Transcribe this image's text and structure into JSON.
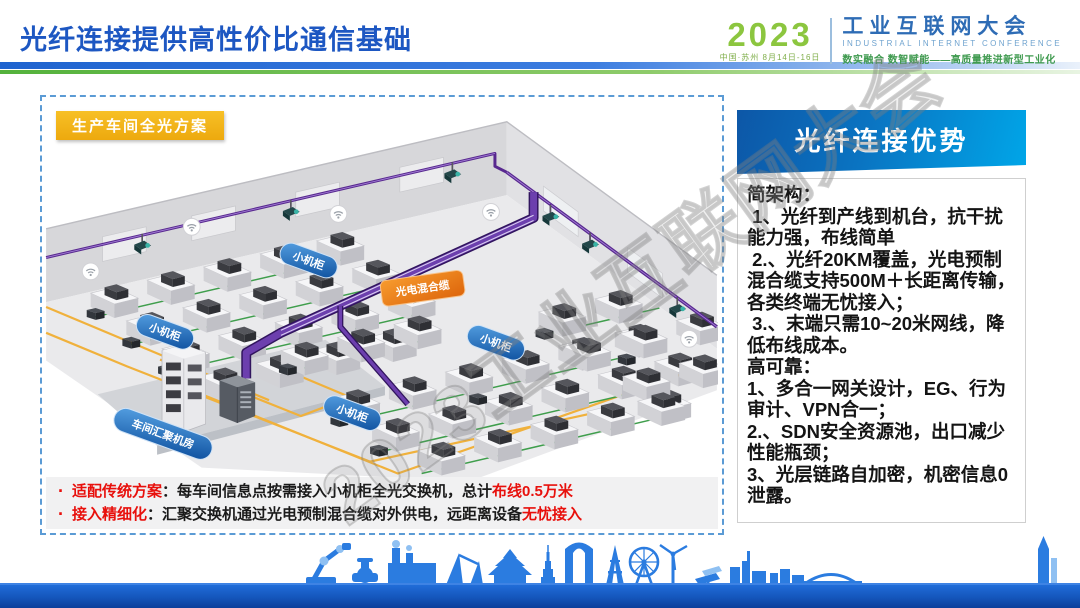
{
  "slide": {
    "title": "光纤连接提供高性价比通信基础"
  },
  "logo": {
    "year": "2023",
    "venue": "中国·苏州 8月14日-16日",
    "name_cn": "工业互联网大会",
    "name_en": "INDUSTRIAL INTERNET CONFERENCE",
    "tagline": "数实融合 数智赋能——高质量推进新型工业化"
  },
  "diagram": {
    "scheme_label": "生产车间全光方案",
    "cabinet_label": "小机柜",
    "hybrid_cable_label": "光电混合缆",
    "aggregation_room_label": "车间汇聚机房"
  },
  "notes": [
    {
      "label": "适配传统方案",
      "text": "：每车间信息点按需接入小机柜全光交换机，总计",
      "highlight": "布线0.5万米"
    },
    {
      "label": "接入精细化",
      "text": "：汇聚交换机通过光电预制混合缆对外供电，远距离设备",
      "highlight": "无忧接入"
    }
  ],
  "advantages": {
    "title": "光纤连接优势",
    "paragraphs": [
      "简架构：",
      " 1、光纤到产线到机台，抗干扰能力强，布线简单",
      " 2.、光纤20KM覆盖，光电预制混合缆支持500M＋长距离传输，各类终端无忧接入；",
      " 3.、末端只需10~20米网线，降低布线成本。",
      "高可靠：",
      "1、多合一网关设计，EG、行为审计、VPN合一；",
      "2.、SDN安全资源池，出口减少性能瓶颈；",
      "3、光层链路自加密，机密信息0泄露。"
    ]
  },
  "watermark": "2023工业互联网大会",
  "colors": {
    "title_blue": "#1d57c2",
    "divider_green": "#54b23c",
    "dashed_border": "#5b9bd5",
    "scheme_label_bg": "#f2b01e",
    "pill_blue": "#1158a8",
    "pill_orange": "#ec7a14",
    "cable_purple": "#5a2b96",
    "cable_green": "#3f9e4c",
    "cable_yellow": "#f0b13c",
    "highlight_red": "#e8100c",
    "panel_header_blue": "#00a6e8",
    "footer_blue": "#1557bd"
  }
}
